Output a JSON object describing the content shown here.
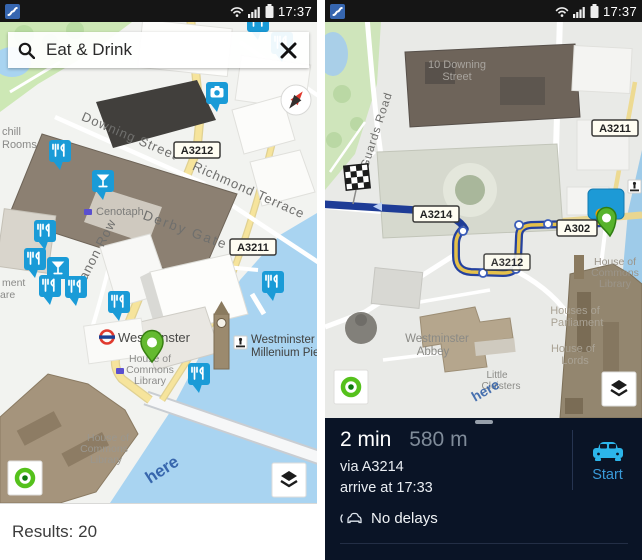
{
  "status_bar": {
    "time": "17:37",
    "app_icon": "here-drive-icon"
  },
  "left_panel": {
    "search": {
      "value": "Eat & Drink",
      "search_icon": "search-icon",
      "clear_icon": "close-icon"
    },
    "results_label": "Results: 20",
    "map": {
      "watermark": "here",
      "road_badges": {
        "a3212": "A3212",
        "a3211": "A3211"
      },
      "street_labels": {
        "downing_street": "Downing Street",
        "richmond_terrace": "Richmond Terrace",
        "canon_row": "Canon Row",
        "derby_gate": "Derby Gate"
      },
      "place_labels": {
        "churchill_rooms": [
          "chill",
          "Rooms"
        ],
        "cenotaph": "Cenotaph",
        "parliament_square_clipped": [
          "ment",
          "are"
        ],
        "westminster_station": "Westminster",
        "commons_library": [
          "House of",
          "Commons",
          "Library"
        ],
        "millenium_pier": [
          "Westminster",
          "Millenium Pier"
        ]
      },
      "poi_types": [
        "restaurant-pin",
        "cocktail-pin",
        "camera-pin",
        "selected-green-pin"
      ]
    }
  },
  "right_panel": {
    "map": {
      "watermark": "here",
      "road_badges": {
        "a3211": "A3211",
        "a3214": "A3214",
        "a302": "A302",
        "a3212": "A3212"
      },
      "street_labels": {
        "guards_road": "se Guards Road"
      },
      "place_labels": {
        "downing_street_10": [
          "10 Downing",
          "Street"
        ],
        "commons_library": [
          "House of",
          "Commons",
          "Library"
        ],
        "houses_of_parliament": [
          "Houses of",
          "Parliament"
        ],
        "westminster_abbey": [
          "Westminster",
          "Abbey"
        ],
        "house_of_lords": [
          "House of",
          "Lords"
        ],
        "little_cloisters": [
          "Little",
          "Cloisters"
        ]
      },
      "route_markers": [
        "destination-checkered-flag",
        "current-position-pin"
      ]
    },
    "route_panel": {
      "duration": "2 min",
      "distance": "580 m",
      "via": "via A3214",
      "arrival": "arrive at 17:33",
      "traffic_status": "No delays",
      "start_label": "Start"
    }
  },
  "colors": {
    "pin_blue": "#1a9bd7",
    "route_blue": "#1e3c96",
    "route_yellow": "#e5c14b",
    "panel_navy": "#0a1426",
    "start_blue": "#2cb5ea",
    "here_logo_blue": "#2b5ba6",
    "water": "#a9d4f1",
    "park": "#cde8b5",
    "selected_pin_green": "#64ba30"
  }
}
